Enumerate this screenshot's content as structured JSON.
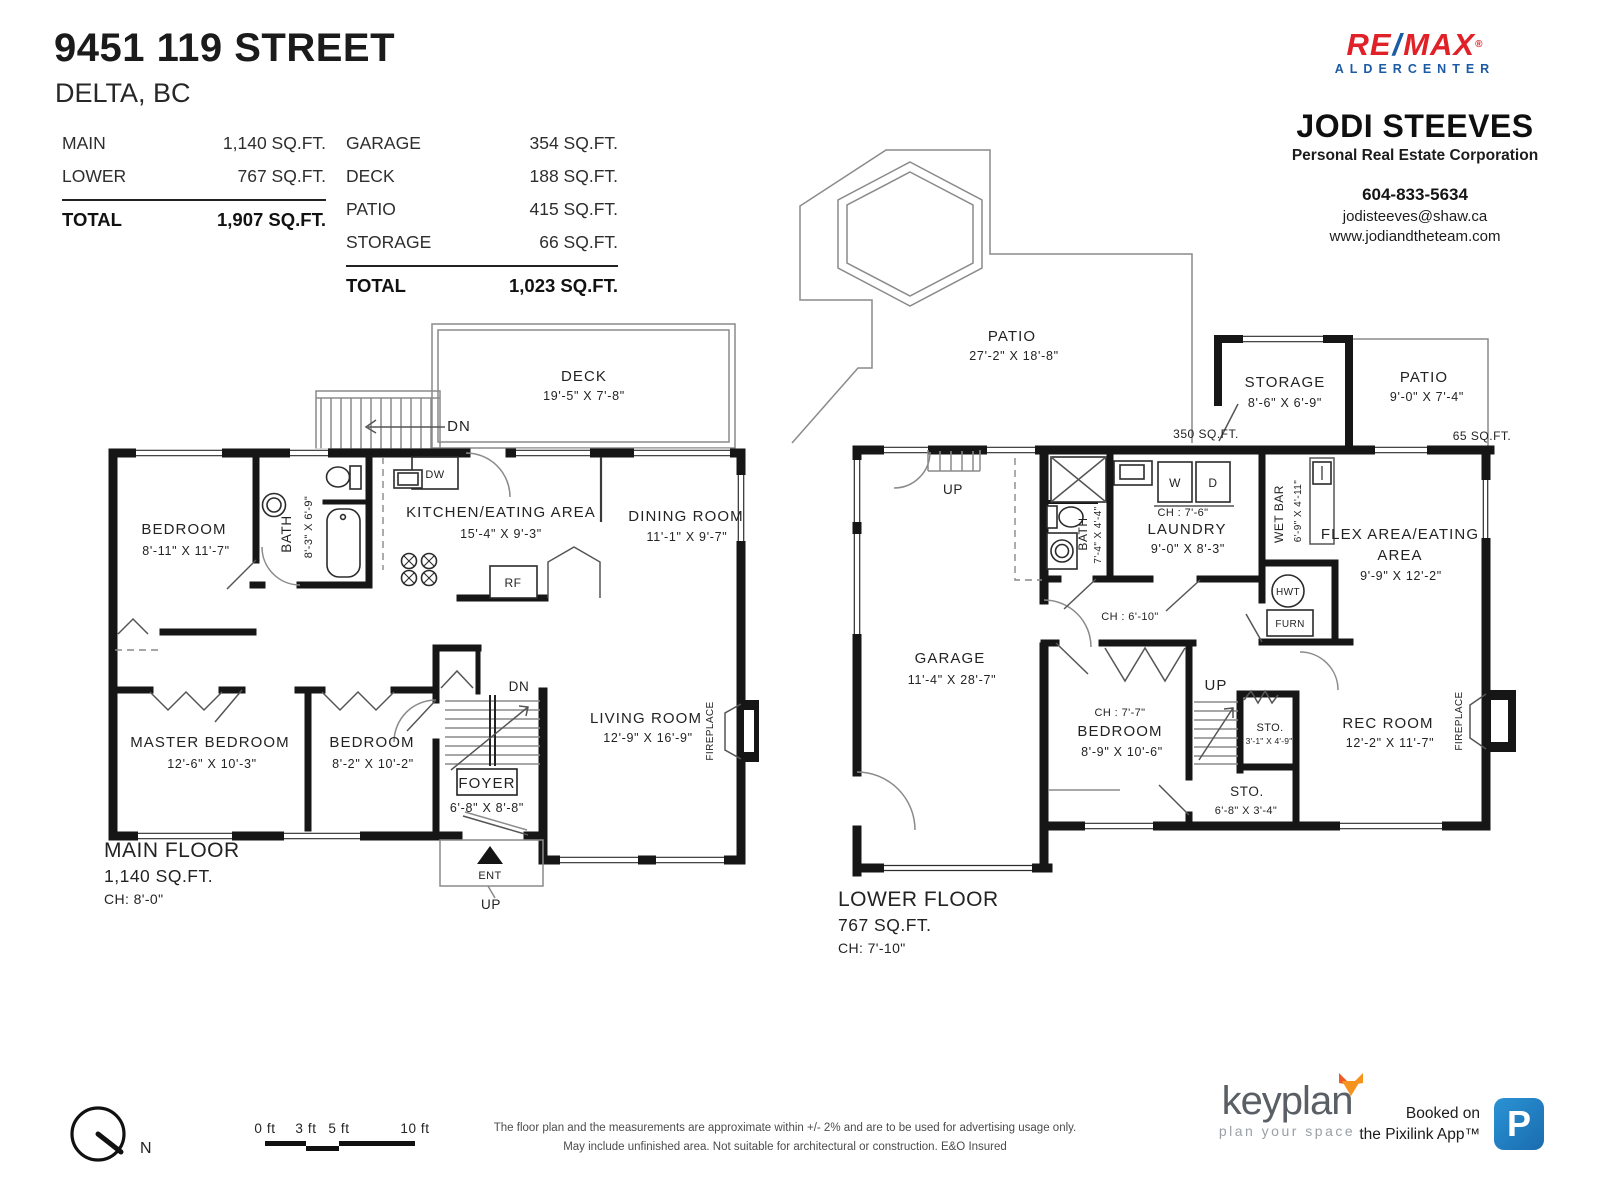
{
  "title": {
    "address": "9451 119 STREET",
    "city": "DELTA, BC"
  },
  "summary": {
    "left": {
      "rows": [
        {
          "label": "MAIN",
          "value": "1,140 SQ.FT."
        },
        {
          "label": "LOWER",
          "value": "767 SQ.FT."
        }
      ],
      "total_label": "TOTAL",
      "total_value": "1,907 SQ.FT."
    },
    "right": {
      "rows": [
        {
          "label": "GARAGE",
          "value": "354 SQ.FT."
        },
        {
          "label": "DECK",
          "value": "188 SQ.FT."
        },
        {
          "label": "PATIO",
          "value": "415 SQ.FT."
        },
        {
          "label": "STORAGE",
          "value": "66 SQ.FT."
        }
      ],
      "total_label": "TOTAL",
      "total_value": "1,023 SQ.FT."
    }
  },
  "agent": {
    "brand_re": "RE",
    "brand_slash": "/",
    "brand_max": "MAX",
    "brand_tm": "®",
    "brand_sub": "ALDERCENTER",
    "name": "JODI STEEVES",
    "designation": "Personal Real Estate Corporation",
    "phone": "604-833-5634",
    "email": "jodisteeves@shaw.ca",
    "website": "www.jodiandtheteam.com"
  },
  "main_floor": {
    "deck": {
      "name": "DECK",
      "dims": "19'-5\" X 7'-8\""
    },
    "stairs_dn": "DN",
    "foyer_dn": "DN",
    "bedroom1": {
      "name": "BEDROOM",
      "dims": "8'-11\" X 11'-7\""
    },
    "bath": {
      "name": "BATH",
      "dims": "8'-3\" X 6'-9\""
    },
    "kitchen": {
      "name": "KITCHEN/EATING AREA",
      "dims": "15'-4\" X 9'-3\""
    },
    "dining": {
      "name": "DINING ROOM",
      "dims": "11'-1\" X 9'-7\""
    },
    "master": {
      "name": "MASTER BEDROOM",
      "dims": "12'-6\" X 10'-3\""
    },
    "bedroom2": {
      "name": "BEDROOM",
      "dims": "8'-2\" X 10'-2\""
    },
    "foyer": {
      "name": "FOYER",
      "dims": "6'-8\" X 8'-8\""
    },
    "living": {
      "name": "LIVING ROOM",
      "dims": "12'-9\" X 16'-9\""
    },
    "fireplace": "FIREPLACE",
    "dw": "DW",
    "rf": "RF",
    "ent": "ENT",
    "up": "UP",
    "footer": {
      "name": "MAIN FLOOR",
      "sqft": "1,140 SQ.FT.",
      "ch": "CH: 8'-0\""
    }
  },
  "lower_floor": {
    "patio": {
      "name": "PATIO",
      "dims": "27'-2\" X 18'-8\"",
      "sqft": "350 SQ.FT."
    },
    "storage": {
      "name": "STORAGE",
      "dims": "8'-6\" X 6'-9\""
    },
    "patio2": {
      "name": "PATIO",
      "dims": "9'-0\" X 7'-4\"",
      "sqft": "65 SQ.FT."
    },
    "garage": {
      "name": "GARAGE",
      "dims": "11'-4\" X 28'-7\""
    },
    "bath": {
      "name": "BATH",
      "dims": "7'-4\" X 4'-4\""
    },
    "laundry": {
      "name": "LAUNDRY",
      "dims": "9'-0\" X 8'-3\"",
      "ch": "CH : 7'-6\""
    },
    "wetbar": {
      "name": "WET BAR",
      "dims": "6'-9\" X 4'-11\""
    },
    "flex": {
      "name1": "FLEX AREA/EATING",
      "name2": "AREA",
      "dims": "9'-9\" X 12'-2\""
    },
    "bedroom": {
      "name": "BEDROOM",
      "dims": "8'-9\" X 10'-6\"",
      "ch": "CH : 7'-7\""
    },
    "sto1": {
      "name": "STO.",
      "dims": "3'-1\" X 4'-9\""
    },
    "sto2": {
      "name": "STO.",
      "dims": "6'-8\" X 3'-4\""
    },
    "rec": {
      "name": "REC ROOM",
      "dims": "12'-2\" X 11'-7\""
    },
    "hall_ch": "CH : 6'-10\"",
    "fireplace": "FIREPLACE",
    "up1": "UP",
    "up2": "UP",
    "w": "W",
    "d": "D",
    "hwt": "HWT",
    "furn": "FURN",
    "footer": {
      "name": "LOWER FLOOR",
      "sqft": "767 SQ.FT.",
      "ch": "CH: 7'-10\""
    }
  },
  "footer": {
    "north": "N",
    "scale": {
      "t0": "0 ft",
      "t3": "3 ft",
      "t5": "5 ft",
      "t10": "10 ft"
    },
    "disclaimer1": "The floor plan and the measurements are approximate within +/- 2% and are to be used for advertising usage only.",
    "disclaimer2": "May include unfinished area. Not suitable for architectural or construction. E&O Insured",
    "keyplan": {
      "brand": "keyplan",
      "tagline": "plan your space"
    },
    "pixilink": {
      "line1": "Booked on",
      "line2": "the Pixilink App™",
      "letter": "P"
    }
  }
}
